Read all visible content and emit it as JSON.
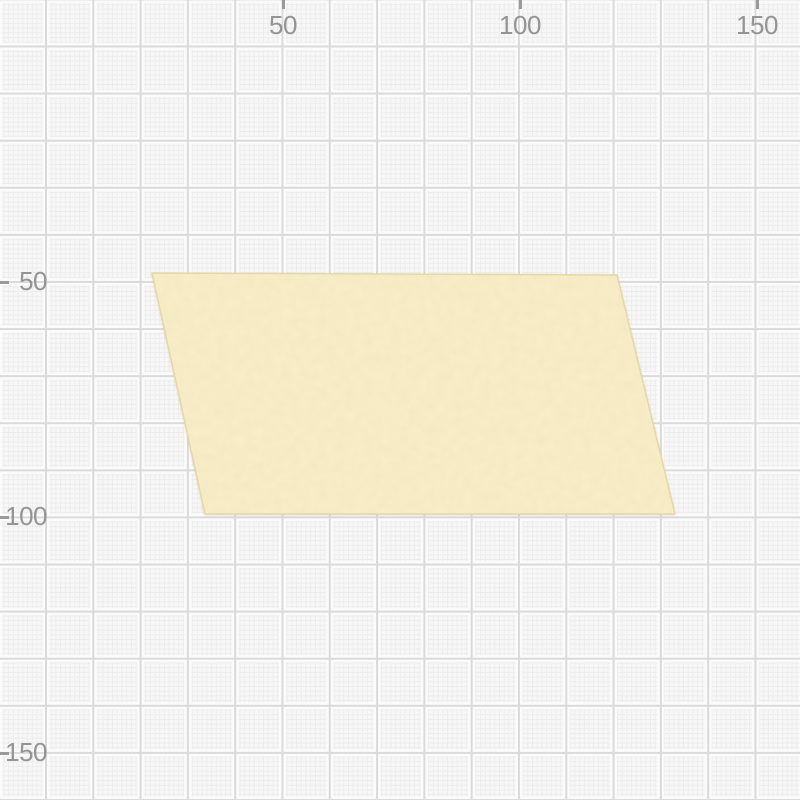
{
  "canvas": {
    "background_color": "#f7f7f7",
    "width_px": 800,
    "height_px": 800
  },
  "grid": {
    "minor_spacing_px": 4.72,
    "major_spacing_px": 47.2,
    "units_per_major_cell": 10,
    "origin_px": {
      "x": 46,
      "y": 46.5
    },
    "minor_color": "#ececec",
    "major_color": "#dadada",
    "halo_color": "#fbfbfb"
  },
  "rulers": {
    "tick_color": "#9a9a9a",
    "label_color": "#949494",
    "top": {
      "labels": [
        {
          "text": "50",
          "x_px": 283
        },
        {
          "text": "100",
          "x_px": 520
        },
        {
          "text": "150",
          "x_px": 757
        }
      ]
    },
    "left": {
      "labels": [
        {
          "text": "50",
          "y_px": 282
        },
        {
          "text": "100",
          "y_px": 517
        },
        {
          "text": "150",
          "y_px": 753
        }
      ]
    }
  },
  "shape": {
    "kind": "parallelogram",
    "fill_color": "#f9eec8",
    "edge_color": "#e7d8a8",
    "corners_px": [
      [
        152,
        273
      ],
      [
        617,
        275
      ],
      [
        675,
        514
      ],
      [
        205,
        514
      ]
    ],
    "corners_units": [
      [
        22.5,
        48
      ],
      [
        121,
        48.5
      ],
      [
        133,
        99
      ],
      [
        34,
        99
      ]
    ]
  }
}
